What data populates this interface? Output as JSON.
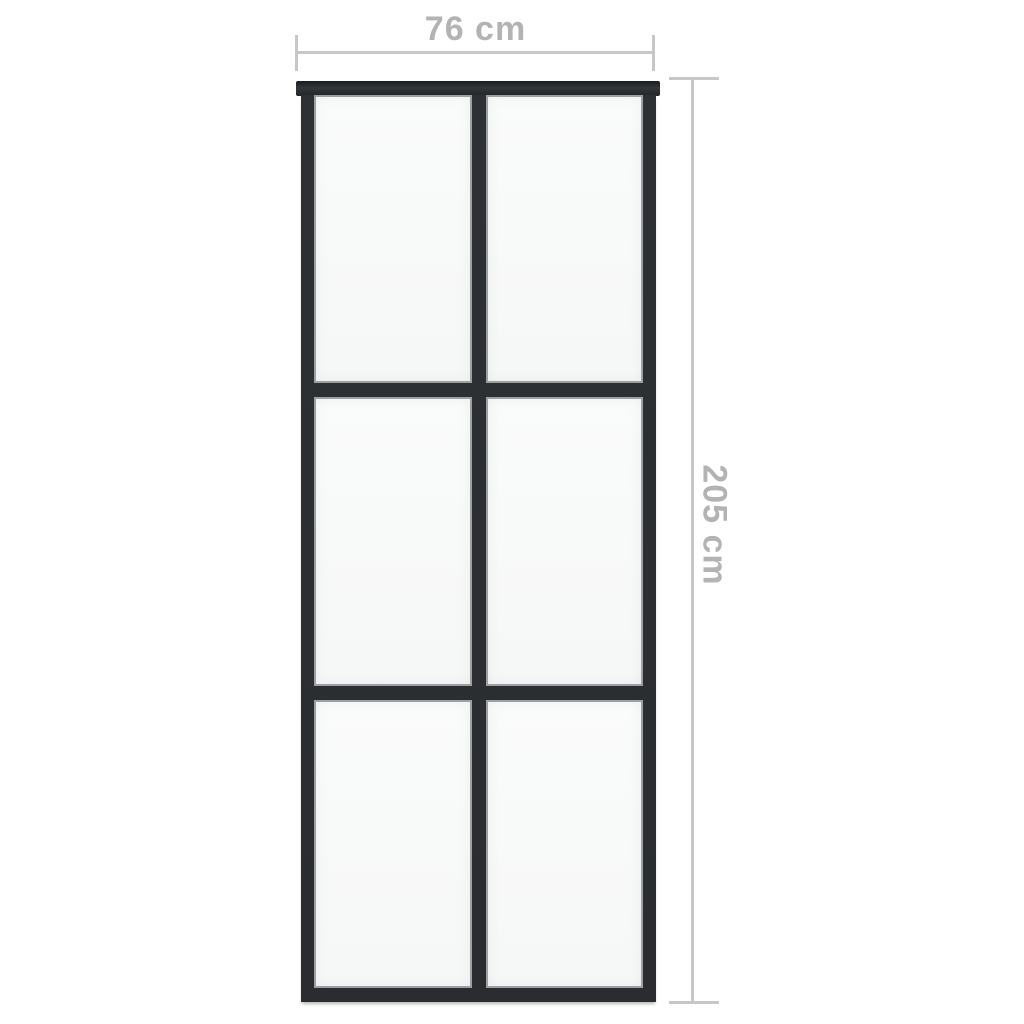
{
  "figure": {
    "type": "product-dimension-diagram",
    "subject": "sliding glass door with black aluminium frame and six clear glass panels (2 columns by 3 rows) hung from a top track",
    "dimensions": {
      "width_label": "76 cm",
      "height_label": "205 cm"
    },
    "panels": {
      "columns": 2,
      "rows": 3,
      "count": 6
    },
    "colors": {
      "background": "#ffffff",
      "frame": "#2b2d30",
      "frame_dark": "#1a1c1e",
      "glass": "#f8f9f9",
      "glass_edge": "#9da0a2",
      "dimension_line": "#c7c7c7",
      "dimension_text": "#b3b3b3"
    }
  }
}
